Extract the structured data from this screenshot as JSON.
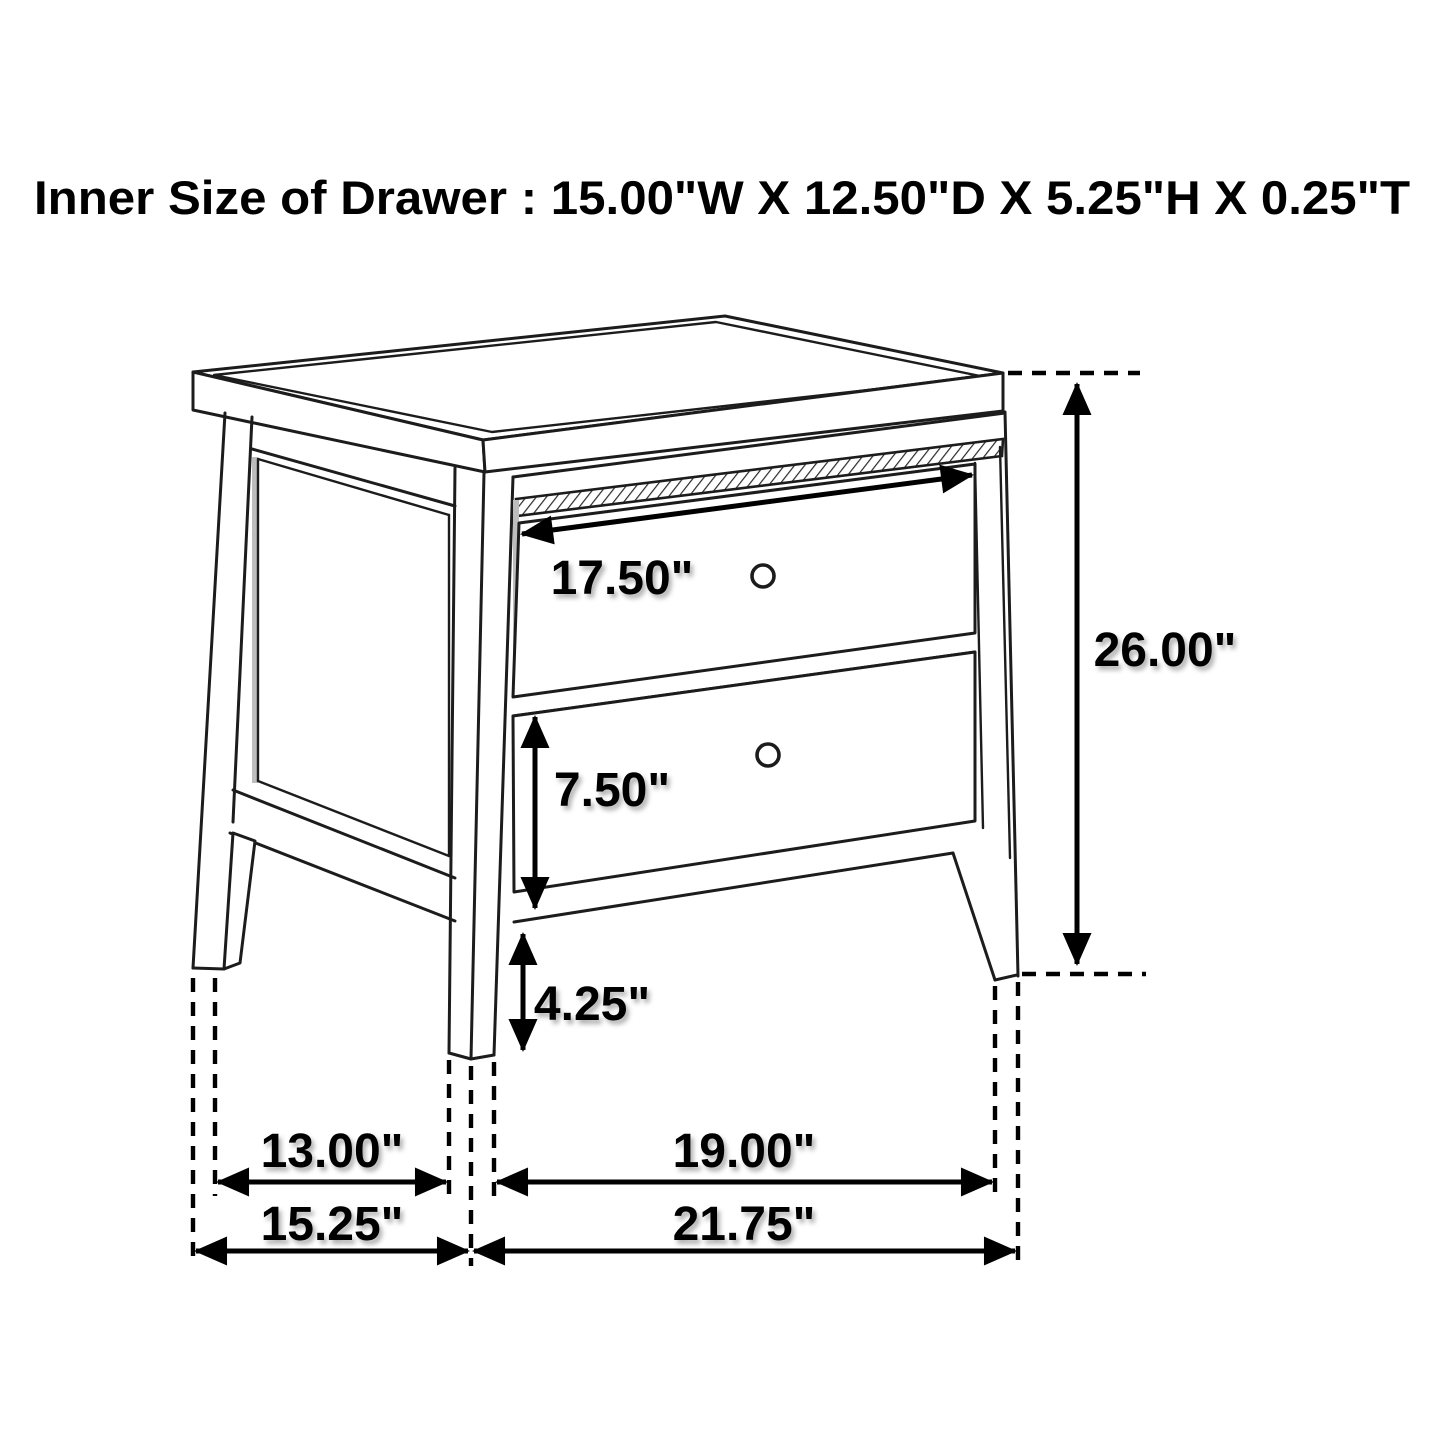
{
  "title": "Inner Size of Drawer : 15.00\"W X 12.50\"D X 5.25\"H X 0.25\"T",
  "diagram": {
    "type": "furniture-dimension-diagram",
    "item": "two-drawer nightstand line drawing (isometric view)",
    "inner_drawer_size": {
      "width": "15.00\"W",
      "depth": "12.50\"D",
      "height": "5.25\"H",
      "thickness": "0.25\"T"
    },
    "dimensions": {
      "drawer_front_width": "17.50\"",
      "overall_height": "26.00\"",
      "bottom_drawer_height": "7.50\"",
      "floor_clearance": "4.25\"",
      "side_leg_span": "13.00\"",
      "overall_depth": "15.25\"",
      "front_leg_span": "19.00\"",
      "overall_width": "21.75\""
    },
    "colors": {
      "line": "#1c1c1c",
      "dimension": "#000000",
      "background": "#ffffff",
      "shading": "#bdbdbd"
    }
  }
}
